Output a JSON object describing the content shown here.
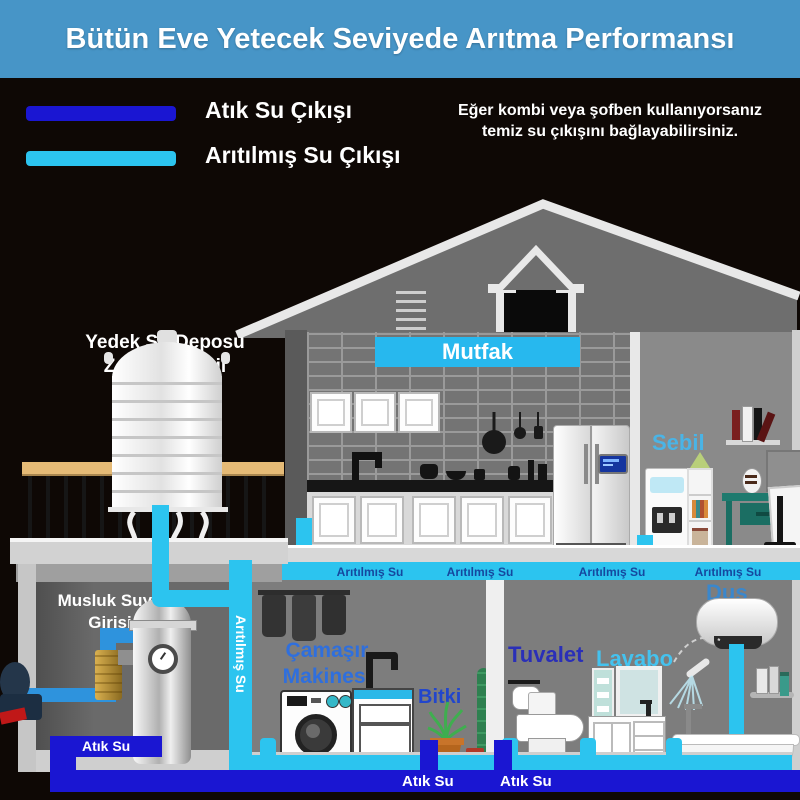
{
  "header": {
    "title": "Bütün Eve Yetecek Seviyede Arıtma Performansı"
  },
  "legend": {
    "waste_label": "Atık Su Çıkışı",
    "clean_label": "Arıtılmış Su Çıkışı",
    "note_line1": "Eğer kombi veya şofben kullanıyorsanız",
    "note_line2": "temiz su çıkışını bağlayabilirsiniz."
  },
  "tank": {
    "line1": "Yedek Su Deposu",
    "line2": "Zorunlu Değil"
  },
  "inlet": {
    "line1": "Musluk Suyu",
    "line2": "Girişi"
  },
  "rooms": {
    "kitchen": "Mutfak",
    "dispenser": "Sebil",
    "washer_line1": "Çamaşır",
    "washer_line2": "Makinesi",
    "plant": "Bitki",
    "toilet": "Tuvalet",
    "basin": "Lavabo",
    "shower": "Duş"
  },
  "pipes": {
    "clean_labels": [
      "Arıtılmış Su",
      "Arıtılmış Su",
      "Arıtılmış Su",
      "Arıtılmış Su"
    ],
    "clean_label_vertical": "Arıtılmış Su",
    "waste_label_filter": "Atık Su",
    "waste_labels_bottom": [
      "Atık Su",
      "Atık Su"
    ]
  },
  "colors": {
    "header_bg": "#4795c7",
    "waste_pipe": "#1a16d2",
    "clean_pipe": "#2cc4ef",
    "inlet_pipe": "#2e93dd",
    "background": "#0e0805",
    "kitchen_label_bg": "#27b8ee"
  }
}
